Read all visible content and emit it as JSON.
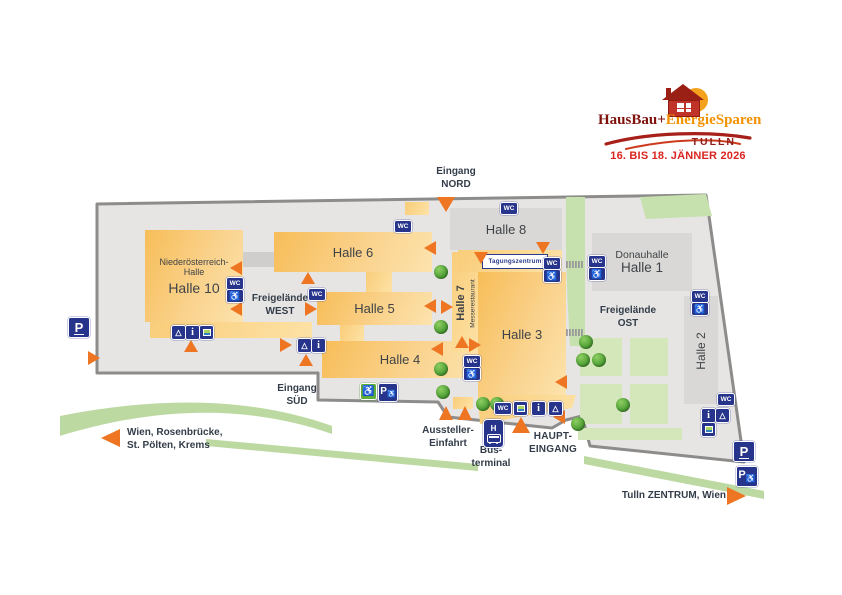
{
  "event": {
    "brand_part1": "HausBau+",
    "brand_part2": "EnergieSparen",
    "brand_city": "TULLN",
    "date_range": "16. BIS 18. JÄNNER 2026"
  },
  "map": {
    "halls": {
      "halle10": {
        "prefix_line1": "Niederösterreich-",
        "prefix_line2": "Halle",
        "name": "Halle 10"
      },
      "halle6": {
        "name": "Halle 6"
      },
      "halle5": {
        "name": "Halle 5"
      },
      "halle4": {
        "name": "Halle 4"
      },
      "halle3": {
        "name": "Halle 3"
      },
      "halle7": {
        "name": "Halle 7",
        "restaurant": "Messerestaurant"
      },
      "halle8": {
        "name": "Halle 8"
      },
      "donauhalle": {
        "line1": "Donauhalle",
        "name": "Halle 1"
      },
      "halle2": {
        "name": "Halle 2"
      },
      "tagungszentrum": {
        "name": "Tagungszentrum"
      }
    },
    "open_areas": {
      "freigelaende_west": {
        "line1": "Freigelände",
        "line2": "WEST"
      },
      "freigelaende_ost": {
        "line1": "Freigelände",
        "line2": "OST"
      }
    },
    "entrances": {
      "nord": {
        "line1": "Eingang",
        "line2": "NORD"
      },
      "sued": {
        "line1": "Eingang",
        "line2": "SÜD"
      },
      "haupt": {
        "line1": "HAUPT-",
        "line2": "EINGANG"
      },
      "aussteller_einfahrt": {
        "line1": "Aussteller-",
        "line2": "Einfahrt"
      },
      "busterminal": {
        "line1": "Bus-",
        "line2": "terminal"
      }
    },
    "road_labels": {
      "west": {
        "line1": "Wien, Rosenbrücke,",
        "line2": "St. Pölten, Krems"
      },
      "east": {
        "label": "Tulln ZENTRUM, Wien"
      }
    },
    "icons": {
      "wc": "WC",
      "parking": "P",
      "info": "i",
      "bus_stop": "H",
      "tent": "△",
      "wheelchair": "♿"
    },
    "colors": {
      "hall_fill": "#f8c666",
      "site_fill": "#e6e5e4",
      "gray_hall_fill": "#d9d8d6",
      "road_green": "#bdd9a2",
      "badge_navy": "#27348b",
      "arrow_orange": "#ee7623",
      "brand_dark_red": "#8e1f1c",
      "brand_orange": "#f29200",
      "date_red": "#da2420"
    }
  }
}
